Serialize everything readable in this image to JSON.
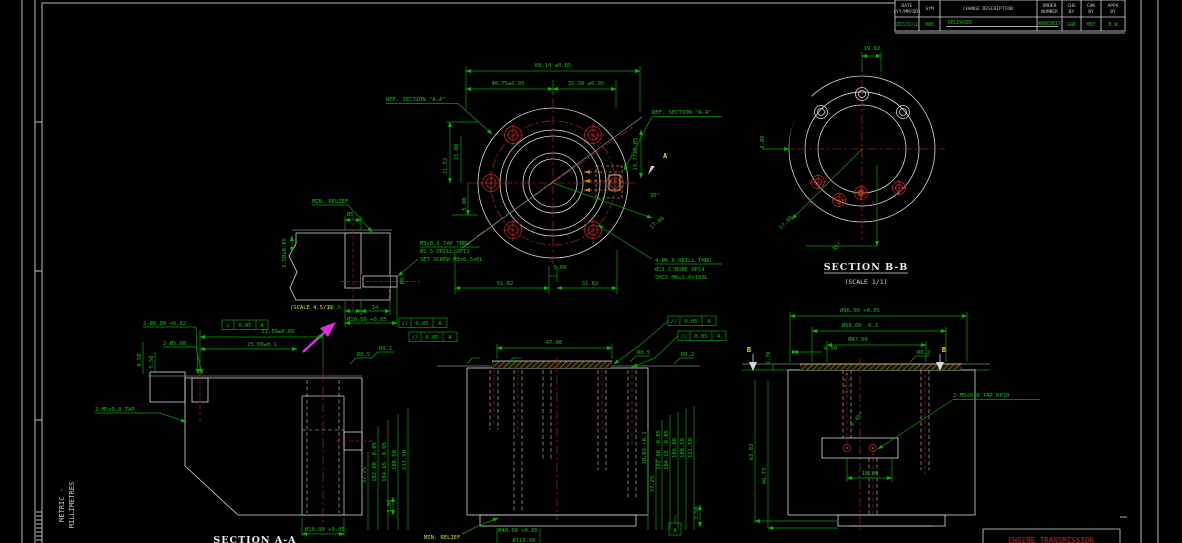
{
  "colors": {
    "background": "#000000",
    "dimension_green": "#00c800",
    "geometry_white": "#d9d9d9",
    "centerline_red": "#9b1c1c",
    "highlight_yellow": "#e6de00",
    "set_screw_orange": "#d08800",
    "annotation_magenta": "#e02ee0",
    "footer_red": "#8f1a1a"
  },
  "frame": {
    "units_line1": "METRIC -",
    "units_line2": "MILLIMETRES"
  },
  "revision_table": {
    "col_date_l1": "DATE",
    "col_date_l2": "(YY/MM/DD)",
    "col_sym": "SYM",
    "col_desc": "CHANGE DESCRIPTION",
    "col_order_l1": "ORDER",
    "col_order_l2": "NUMBER",
    "col_chg_l1": "CHG",
    "col_chg_l2": "BY",
    "col_chk_l1": "CHK",
    "col_chk_l2": "BY",
    "col_appv_l1": "APPV",
    "col_appv_l2": "BY",
    "val_date": "2013/02/12",
    "val_sym": "000",
    "val_desc": "RELEASED",
    "val_order": "W905817",
    "val_chg": "GGK",
    "val_chk": "HKY",
    "val_appv": "B.W"
  },
  "front_view": {
    "ref_left": "REF. SECTION \"A-A\"",
    "ref_right": "REF. SECTION \"A-A\"",
    "dim_overall": "89.14 ±0.05",
    "dim_left_top": "46.75±0.05",
    "dim_right_top": "31.50 ±0.05",
    "dim_v1": "15.00",
    "dim_v2": "31.52",
    "dim_v3": "5.00",
    "dim_bottom_small": "5.00",
    "dim_bottom_left": "51.82",
    "dim_bottom_right": "31.82",
    "dim_right_v": "19.77±0.05",
    "dim_diag": "17.00",
    "dim_angle": "35°",
    "section_letter": "A",
    "note_line1": "4-Ø6.6 DRILL THRU",
    "note_line2": "Ø11 C'BORE DP14",
    "note_line3": "SHCS M6x1.0x100L"
  },
  "section_b_view": {
    "title": "SECTION B-B",
    "scale": "(SCALE 1/1)",
    "dim_top": "19.02",
    "dim_left": "2.00",
    "dim_diag": "17.00",
    "dim_angle": "35°"
  },
  "detail_view": {
    "label": "MIN. RELIEF",
    "scale": "(SCALE 4.5/1)",
    "dim_dia": "Ø5",
    "note_line1": "M3x0.5 TAP THRU",
    "note_line2": "Ø2.5 DRILL DP11",
    "note_line3": "SET SCREW M3x0.5x6L",
    "dim_left": "2.50±0.05",
    "dim_b1": "Ø2.5",
    "dim_b2": "14",
    "dim_b3": "Ø10.50 +0.05",
    "dim_right": "Ø8",
    "gdt1_sym": "//",
    "gdt1_tol": "0.05",
    "gdt1_datum": "A",
    "gdt2_sym": "//",
    "gdt2_tol": "0.05",
    "gdt2_datum": "A"
  },
  "section_a_view": {
    "title": "SECTION A-A",
    "dim_holes1": "2-Ø8.00 +0.02",
    "dim_holes2": "2-Ø5.00",
    "gdt_sym": "⊥",
    "gdt_tol": "0.05",
    "gdt_datum": "A",
    "dim_h1": "31.50±0.05",
    "dim_h2": "25.00±0.1",
    "dim_left1": "8.50",
    "dim_left2": "5.50",
    "note_tap": "2-M5x0.8 TAP",
    "stack": [
      "37.25",
      "102.00 -0.05",
      "104.65 -0.05",
      "108.50",
      "111.50"
    ],
    "dim_base": "3.00",
    "dim_bottom": "Ø10.00 +0.05",
    "r1": "R0.5",
    "r2": "R0.2"
  },
  "middle_view": {
    "dim_top": "47.00",
    "gdt1_sym": "//",
    "gdt1_tol": "0.05",
    "gdt1_datum": "A",
    "gdt2_sym": "//",
    "gdt2_tol": "0.05",
    "gdt2_datum": "A",
    "stack": [
      "18.03 +0.1",
      "37.25",
      "102.00 -0.05",
      "104.65 -0.05",
      "106.00",
      "108.50",
      "111.50"
    ],
    "dim_small": "3.50",
    "datum_label": "A",
    "relief_label": "MIN. RELIEF",
    "dim_bottom1": "Ø40.00 +0.05",
    "dim_bottom2": "Ø110.00",
    "r1": "R0.5",
    "r2": "R0.2"
  },
  "right_view": {
    "section_letter": "B",
    "dim_d1": "Ø96.00 +0.05",
    "dim_d2": "Ø58.00 -0.1",
    "dim_d3": "Ø47.00",
    "dim_d4": "0.50",
    "dim_left_v": "1.70",
    "stack_left": [
      "63.92",
      "46.73"
    ],
    "dim_center": "18.00",
    "chamfer": "2-45°",
    "note_tap": "2-M5x0.8 TAP DP10",
    "r1": "R0.2"
  },
  "footer": {
    "partial_title": "ENGINE TRANSMISSION"
  }
}
